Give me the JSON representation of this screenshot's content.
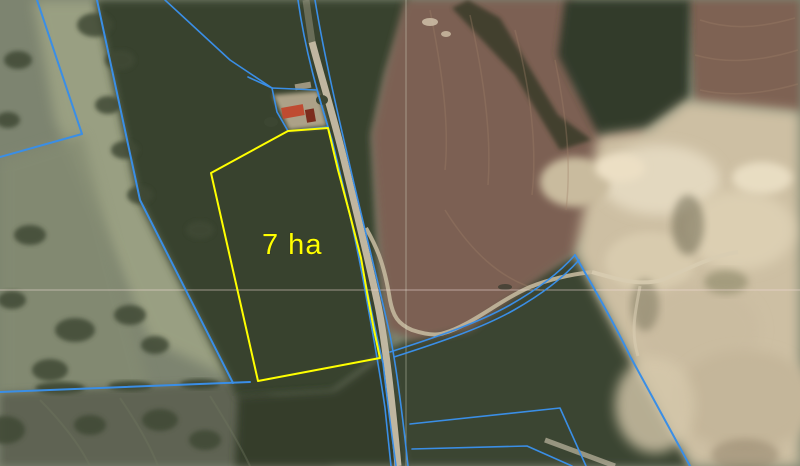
{
  "map": {
    "area_label": "7 ha",
    "highlighted_parcel_area_ha": 7
  },
  "colors": {
    "parcel_blue": "#3a8ee6",
    "parcel_yellow": "#ffff00",
    "graticule_h": "#f2dcd8",
    "graticule_v": "#e6ecd6"
  }
}
